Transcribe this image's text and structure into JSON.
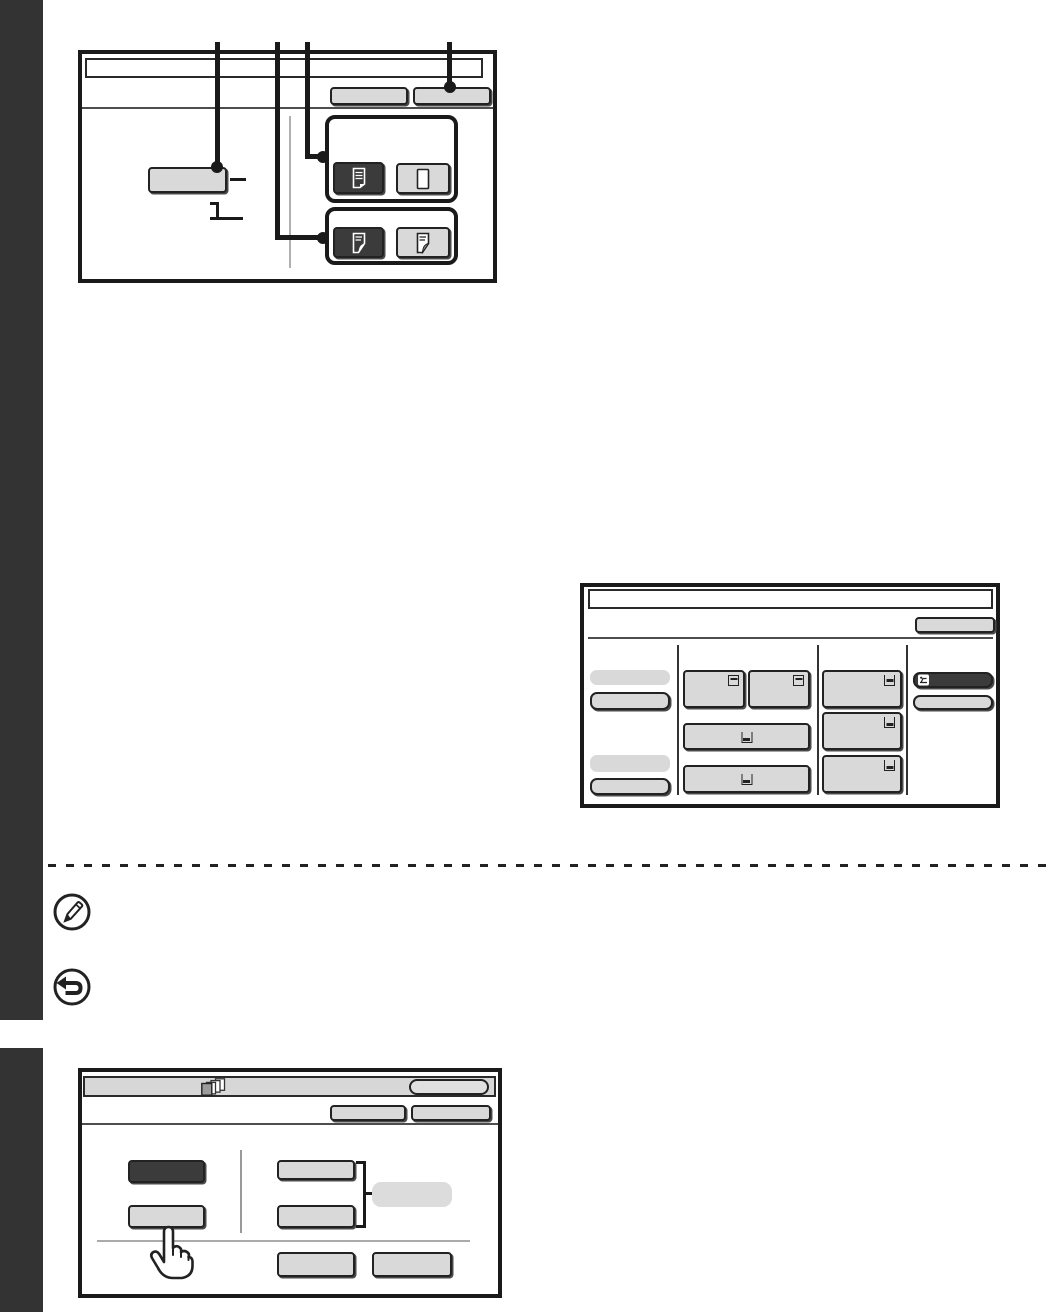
{
  "page": {
    "background": "#ffffff",
    "sidebar_color": "#333333",
    "separator_style": "dashed-line"
  },
  "colors": {
    "panel_border": "#1a1a1a",
    "button_face": "#d9d9d9",
    "button_selected": "#3b3b3b",
    "titlebar_gray": "#d7d7d7",
    "callout": "#1a1a1a",
    "soft_divider": "#b0b0b0"
  },
  "icons": [
    "document-with-lines-icon",
    "blank-document-icon",
    "two-sided-document-icon",
    "tray-level-icon",
    "bypass-tray-icon",
    "page-stack-icon",
    "note-pencil-icon",
    "back-arrow-icon",
    "touch-hand-icon"
  ],
  "top_panel": {
    "title": "",
    "header_buttons": [
      {
        "label": ""
      },
      {
        "label": ""
      }
    ],
    "original_button": {
      "label": ""
    },
    "duplex_group_top": {
      "selected": "document-with-lines-icon",
      "unselected": "blank-document-icon"
    },
    "duplex_group_bottom": {
      "selected": "two-sided-document-icon",
      "unselected": "two-sided-document-icon"
    },
    "callouts": 4
  },
  "paper_panel": {
    "title": "",
    "header_button": {
      "label": ""
    },
    "left_column": {
      "labels": [
        "",
        ""
      ],
      "buttons": [
        "",
        ""
      ]
    },
    "tray_buttons_mid": [
      "",
      "",
      "",
      ""
    ],
    "tray_buttons_right": [
      "",
      "",
      ""
    ],
    "bypass_button": {
      "label": "",
      "selected": true
    },
    "extra_button": {
      "label": ""
    }
  },
  "special_modes_panel": {
    "title": "",
    "titlebar_button": {
      "label": ""
    },
    "header_buttons": [
      {
        "label": ""
      },
      {
        "label": ""
      }
    ],
    "left_buttons": [
      {
        "label": "",
        "selected": true
      },
      {
        "label": "",
        "selected": false
      }
    ],
    "right_buttons": [
      {
        "label": ""
      },
      {
        "label": ""
      }
    ],
    "bracket_button": {
      "label": ""
    },
    "bottom_buttons": [
      {
        "label": ""
      },
      {
        "label": ""
      }
    ]
  },
  "notes": {
    "note_text": "",
    "cancel_text": ""
  }
}
